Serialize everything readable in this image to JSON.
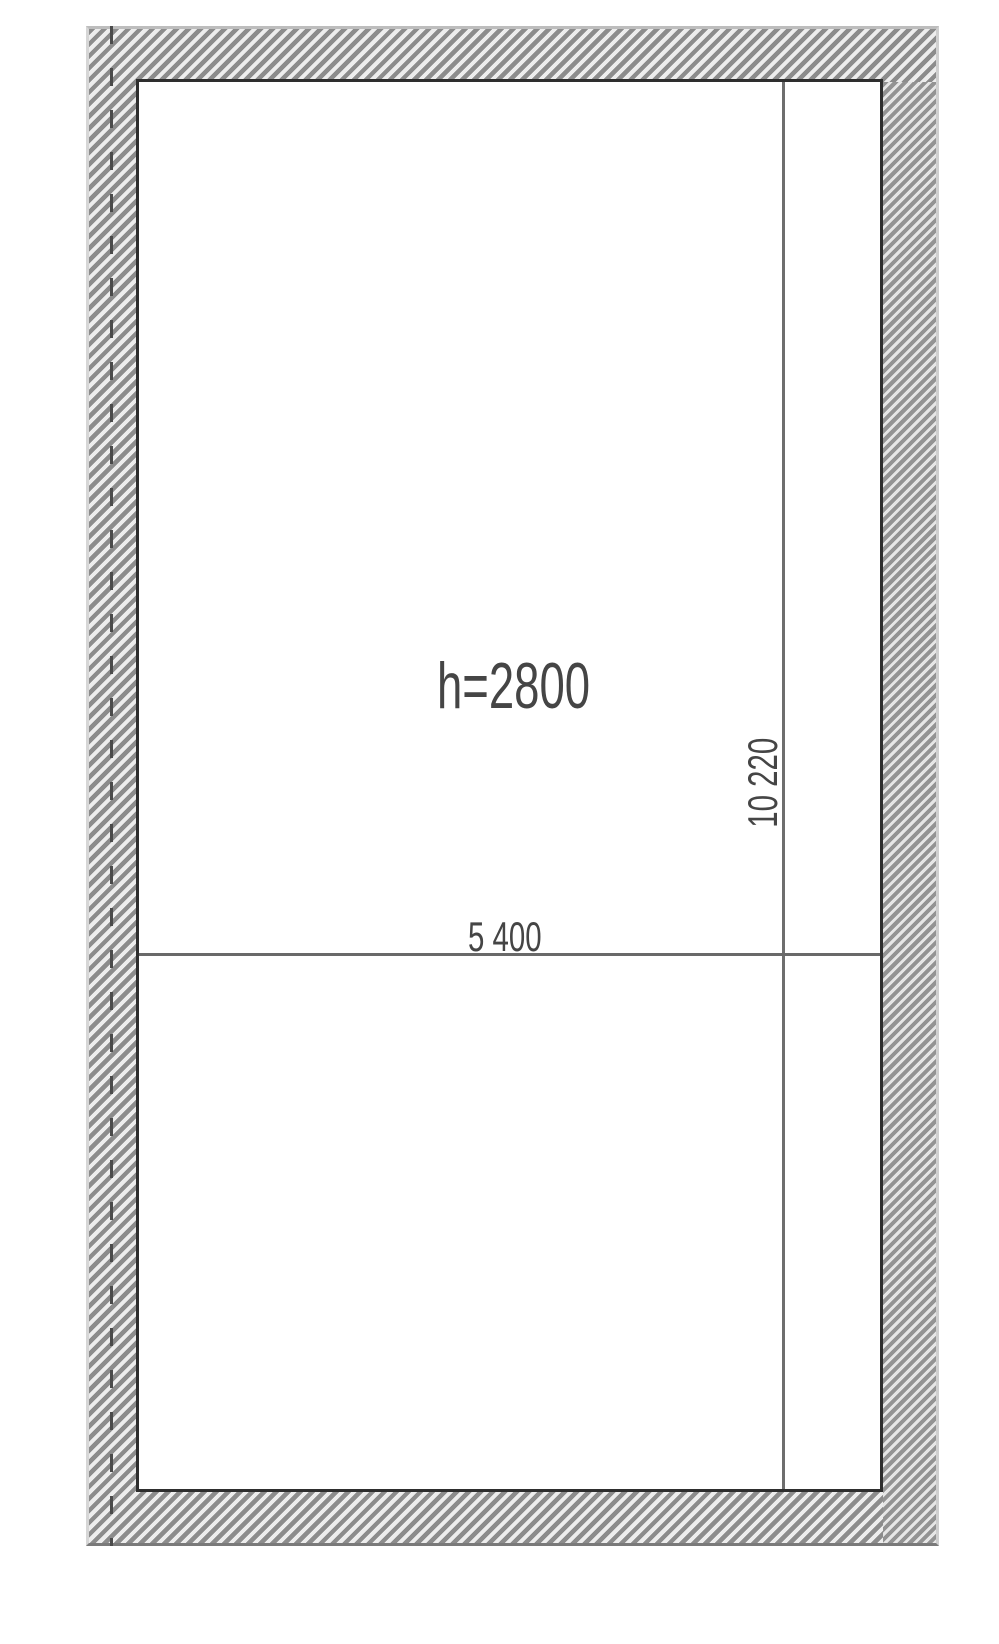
{
  "drawing": {
    "type": "floor-plan-fragment",
    "labels": {
      "ceiling_height": "h=2800",
      "room_width": "5 400",
      "room_length": "10 220"
    },
    "colors": {
      "background": "#ffffff",
      "hatch_stripe": "#8c8c8c",
      "hatch_gap": "#ededed",
      "wall_inner_outline": "#2e2e2e",
      "outer_edge_light": "#bdbdbd",
      "outer_edge_dark": "#7a7a7a",
      "dimension_line": "#6e6e6e",
      "axis_dash": "#4b4b4b",
      "text": "#454545"
    }
  }
}
